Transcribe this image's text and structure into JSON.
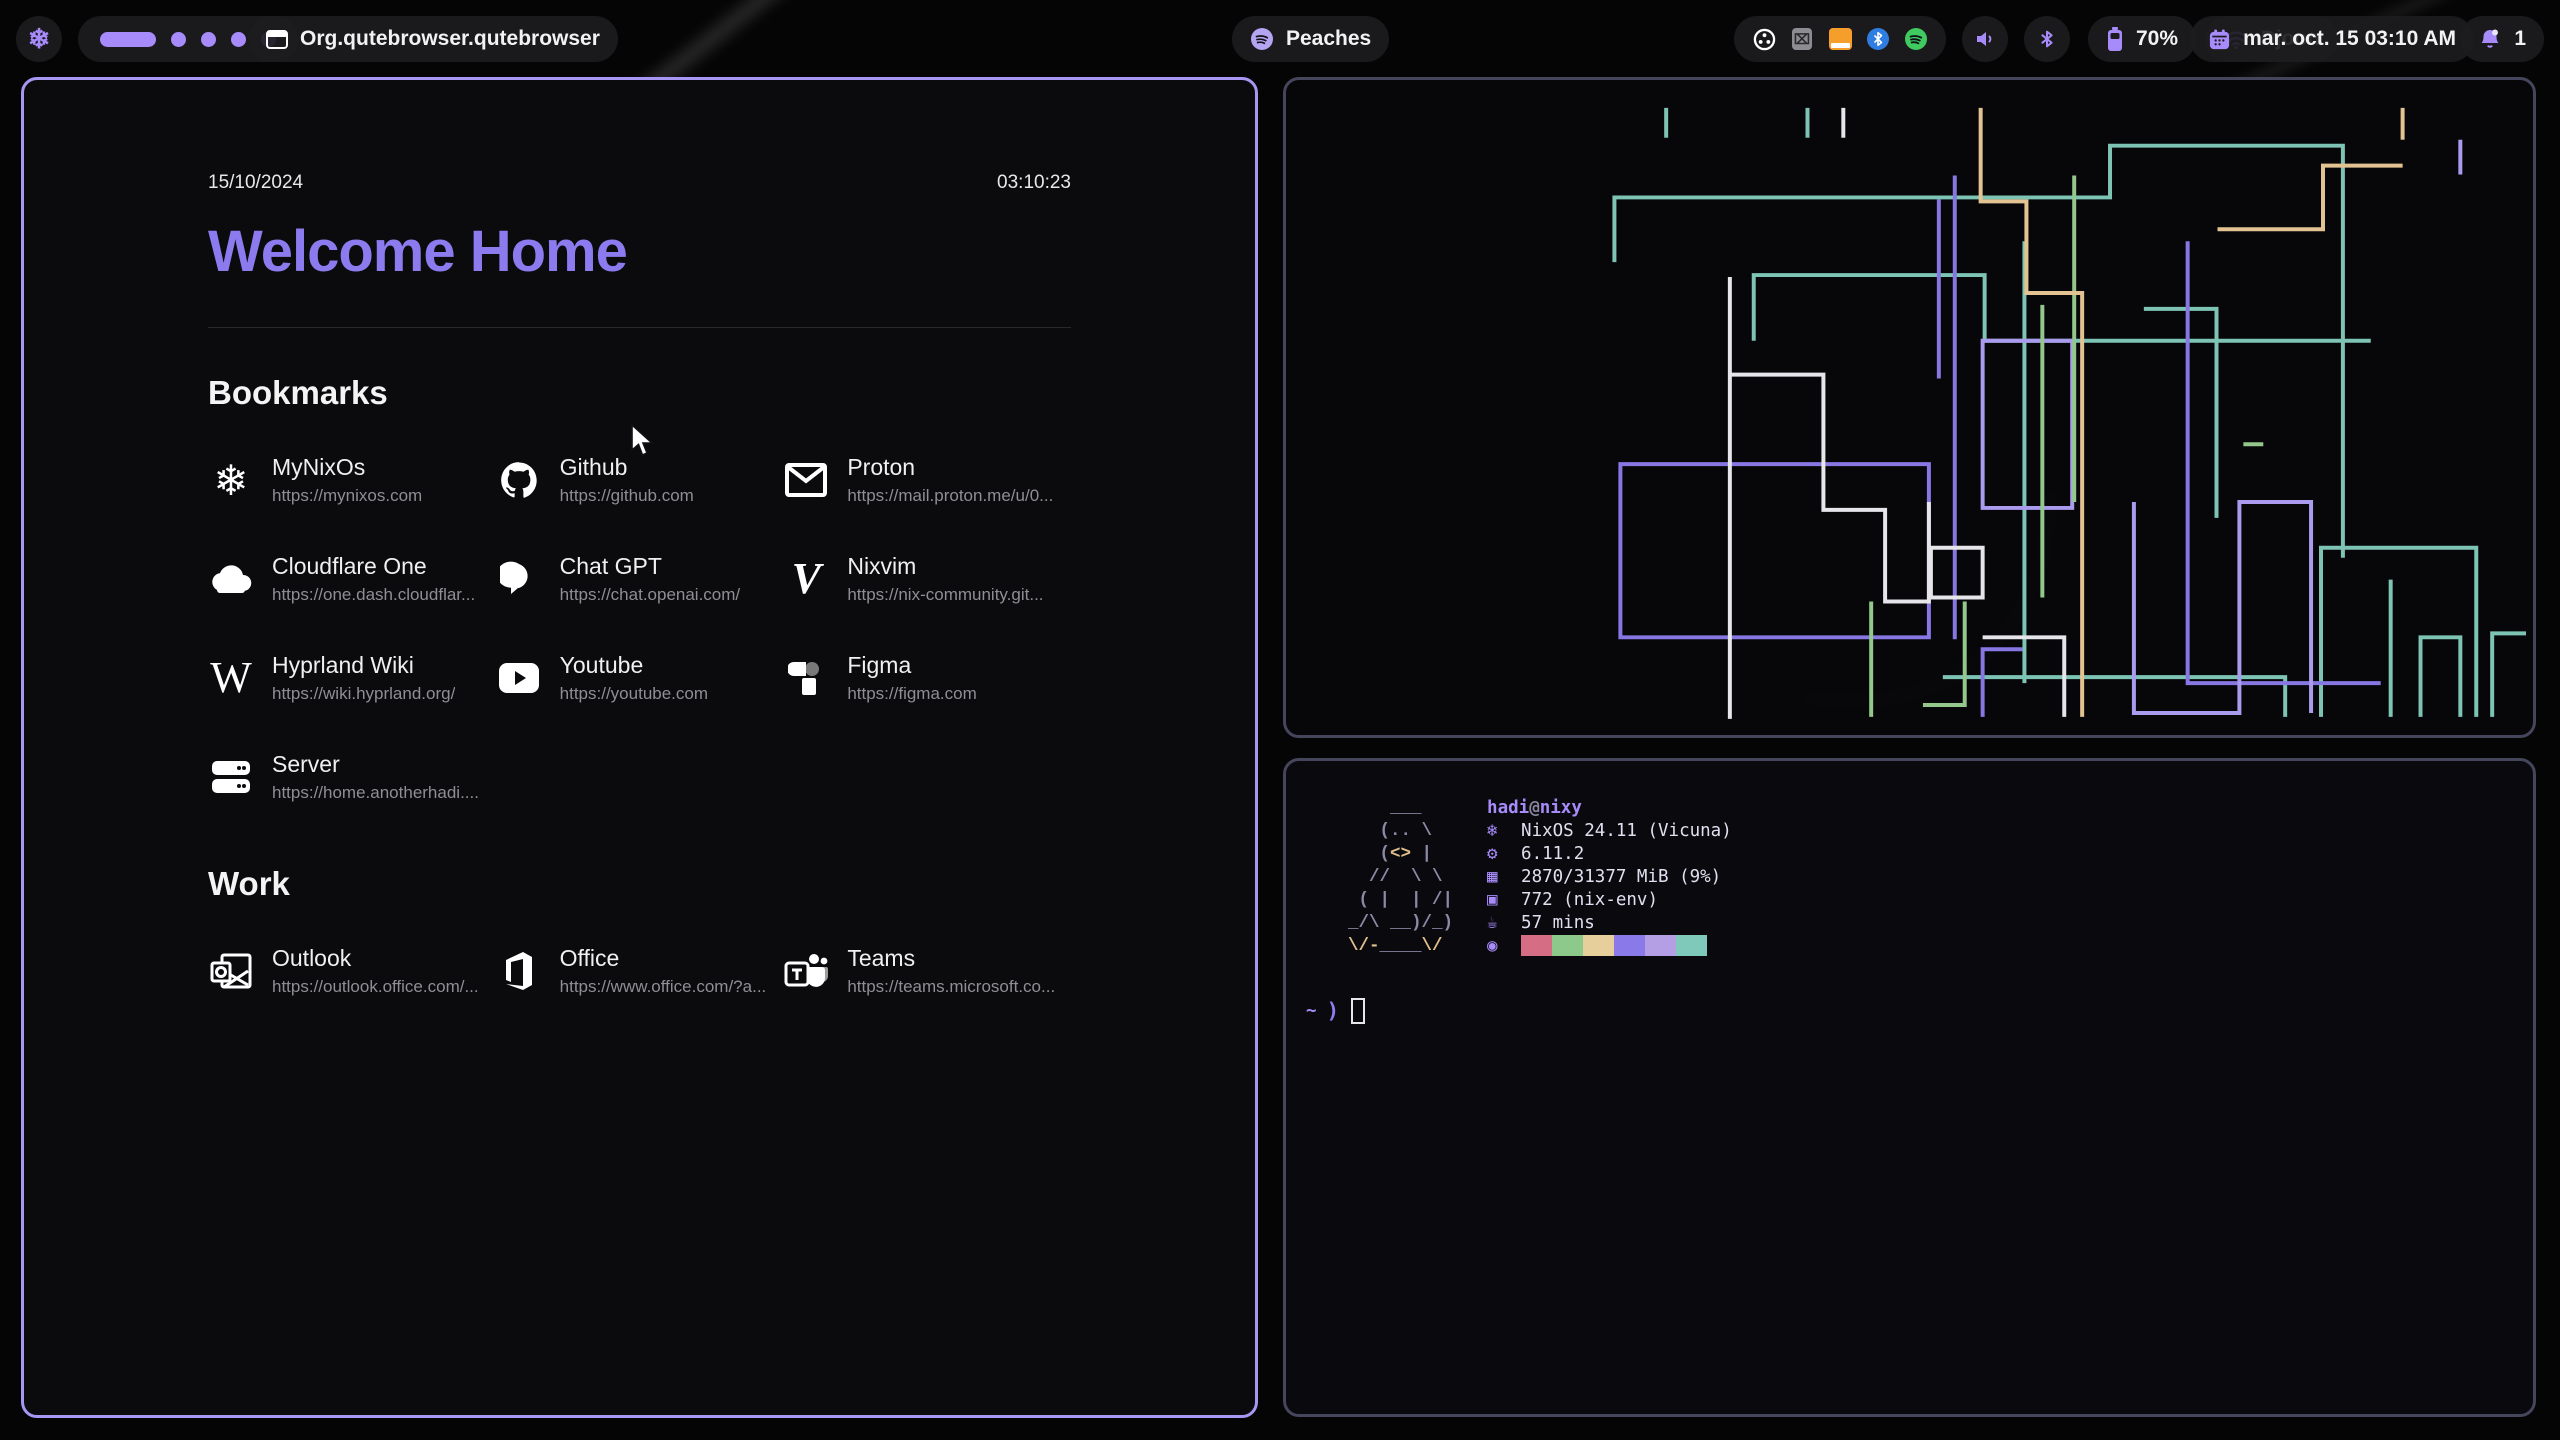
{
  "bar": {
    "launcher": {
      "icon": "nix-snowflake",
      "glyph": "❄"
    },
    "workspaces": {
      "active": 1,
      "total": 5
    },
    "window_title": "Org.qutebrowser.qutebrowser",
    "media": {
      "icon": "spotify",
      "label": "Peaches"
    },
    "tray_icons": [
      "obs",
      "keepass",
      "file-manager",
      "bluetooth",
      "spotify"
    ],
    "battery": {
      "percent": "70%"
    },
    "network": {
      "ssid": "Djoon"
    },
    "clock": {
      "label": "mar. oct. 15  03:10 AM"
    },
    "notifications": {
      "count": "1"
    },
    "accent": "#a78bfa"
  },
  "startpage": {
    "date": "15/10/2024",
    "time": "03:10:23",
    "title": "Welcome Home",
    "title_color": "#8c7bef",
    "sections": [
      {
        "label": "Bookmarks",
        "links": [
          {
            "icon": "nix-snowflake",
            "name": "MyNixOs",
            "url": "https://mynixos.com"
          },
          {
            "icon": "github",
            "name": "Github",
            "url": "https://github.com"
          },
          {
            "icon": "envelope",
            "name": "Proton",
            "url": "https://mail.proton.me/u/0..."
          },
          {
            "icon": "cloud",
            "name": "Cloudflare One",
            "url": "https://one.dash.cloudflar..."
          },
          {
            "icon": "chat-bubble",
            "name": "Chat GPT",
            "url": "https://chat.openai.com/"
          },
          {
            "icon": "letter-v",
            "name": "Nixvim",
            "url": "https://nix-community.git..."
          },
          {
            "icon": "letter-w",
            "name": "Hyprland Wiki",
            "url": "https://wiki.hyprland.org/"
          },
          {
            "icon": "youtube",
            "name": "Youtube",
            "url": "https://youtube.com"
          },
          {
            "icon": "figma",
            "name": "Figma",
            "url": "https://figma.com"
          },
          {
            "icon": "server",
            "name": "Server",
            "url": "https://home.anotherhadi...."
          }
        ]
      },
      {
        "label": "Work",
        "links": [
          {
            "icon": "outlook",
            "name": "Outlook",
            "url": "https://outlook.office.com/..."
          },
          {
            "icon": "office",
            "name": "Office",
            "url": "https://www.office.com/?a..."
          },
          {
            "icon": "teams",
            "name": "Teams",
            "url": "https://teams.microsoft.co..."
          }
        ]
      }
    ]
  },
  "fetch": {
    "user": "hadi",
    "separator": "@",
    "host": "nixy",
    "art": {
      "l1": "    ___",
      "l2": "   (.. \\",
      "l3a": "   (",
      "l3b": "<>",
      "l3c": " |",
      "l4": "  //  \\ \\",
      "l5": " ( |  | /|",
      "l6": "_/\\ __)/_)",
      "l7a": "\\/-",
      "l7b": "____",
      "l7c": "\\/"
    },
    "rows": [
      {
        "icon": "nix-snowflake",
        "glyph": "❄",
        "text": "NixOS 24.11 (Vicuna)"
      },
      {
        "icon": "kernel",
        "glyph": "⚙",
        "text": "6.11.2"
      },
      {
        "icon": "memory",
        "glyph": "▦",
        "text": "2870/31377 MiB (9%)"
      },
      {
        "icon": "packages",
        "glyph": "▣",
        "text": "772 (nix-env)"
      },
      {
        "icon": "uptime",
        "glyph": "☕",
        "text": "57 mins"
      },
      {
        "icon": "palette",
        "glyph": "◉",
        "text": ""
      }
    ],
    "palette": [
      "#d56d85",
      "#8cc98a",
      "#e7cf9b",
      "#8a79e8",
      "#b49fe4",
      "#7fc9bb"
    ],
    "prompt": {
      "path": "~",
      "symbol": ")"
    }
  },
  "pipes_colors": {
    "teal": "#7ec4b5",
    "purple": "#8677e2",
    "lavender": "#aa9bef",
    "green": "#93c78b",
    "white": "#e6e6ea",
    "tan": "#e4c393"
  }
}
